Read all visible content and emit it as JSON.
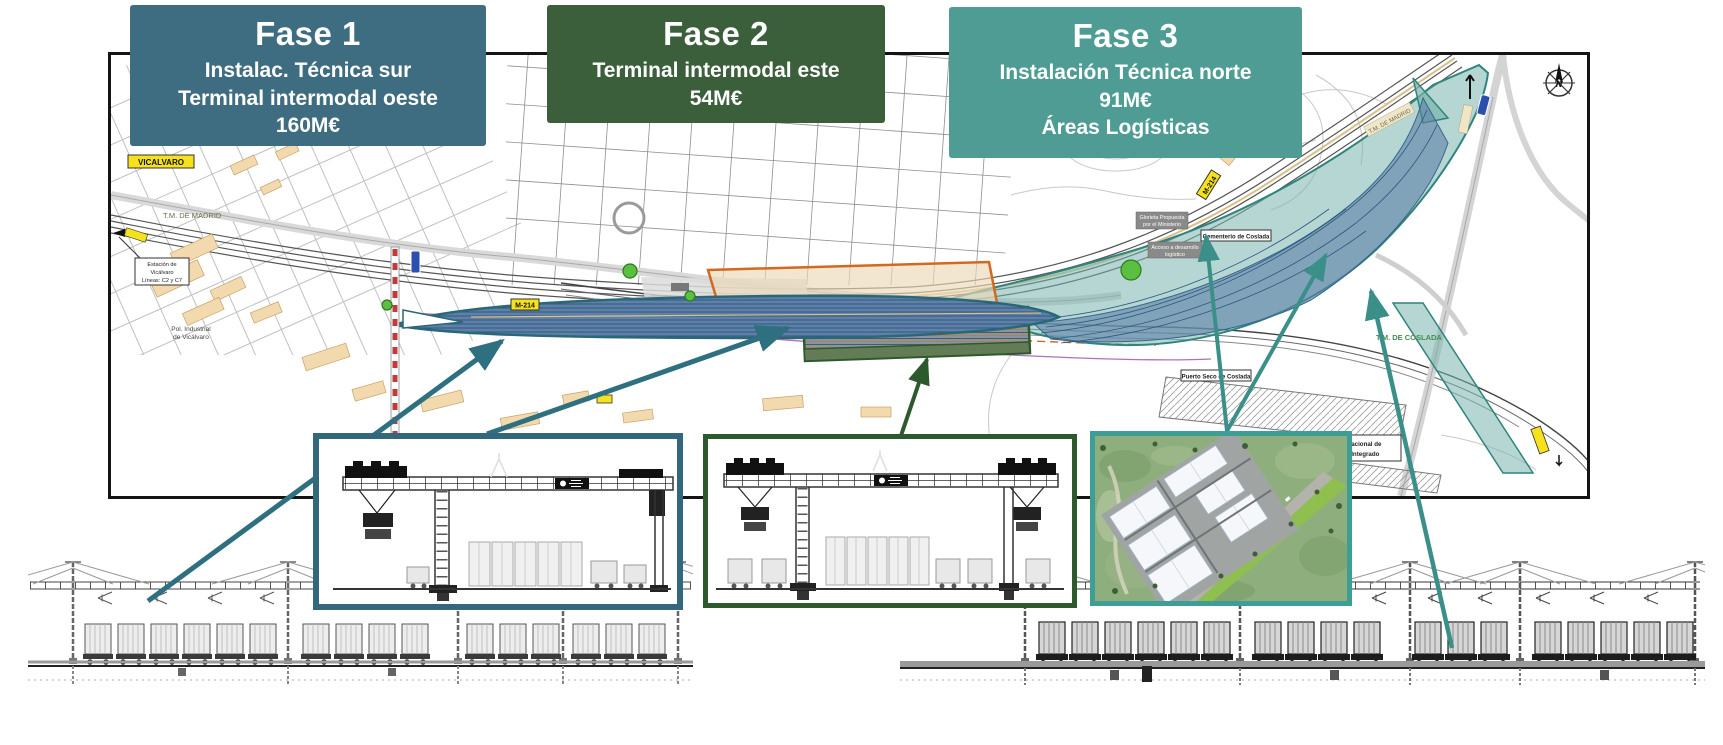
{
  "phases": [
    {
      "title": "Fase 1",
      "lines": [
        "Instalac. Técnica sur",
        "Terminal intermodal oeste",
        "160M€"
      ],
      "color": "#3e6c80"
    },
    {
      "title": "Fase 2",
      "lines": [
        "Terminal intermodal este",
        "54M€"
      ],
      "color": "#3b5e3b"
    },
    {
      "title": "Fase 3",
      "lines": [
        "Instalación Técnica norte",
        "91M€",
        "Áreas Logísticas"
      ],
      "color": "#4e9c94"
    }
  ],
  "colors": {
    "connector_teal_dark": "#2e6f80",
    "connector_teal": "#3a9089",
    "connector_green": "#2d5a2d",
    "fase1_area_fill": "#5d81a8",
    "fase1_area_stroke": "#2a6879",
    "fase2_area_stroke": "#2d5a2d",
    "fase3_area_fill": "#79b5ad",
    "fase3_area_stroke": "#2f847c",
    "orange_area_stroke": "#d2691e",
    "road_label_yellow": "#f5e21c",
    "road_label_blue": "#2a4fae"
  },
  "map": {
    "labels": {
      "vicalvaro": "VICALVARO",
      "tm_madrid_left": "T.M. DE MADRID",
      "estacion_1": "Estación de",
      "estacion_2": "Vicálvaro",
      "estacion_3": "Líneas: C2 y C7",
      "pol_industrial_1": "Pol. Industrial",
      "pol_industrial_2": "de Vicálvaro",
      "m214_west": "M-214",
      "m214_east": "M-214",
      "glorieta_1": "Glorieta Propuesta",
      "glorieta_2": "por el Ministerio",
      "acceso_1": "Acceso a desarrollo",
      "acceso_2": "logístico",
      "cementerio": "Cementerio de Coslada",
      "puerto_seco": "Puerto Seco de Coslada",
      "tm_coslada": "T.M. DE COSLADA",
      "tm_madrid_right": "T.M. DE MADRID",
      "citi_1": "o Internacional de",
      "citi_2": "sporte Integrado",
      "compass_n": "N"
    }
  }
}
